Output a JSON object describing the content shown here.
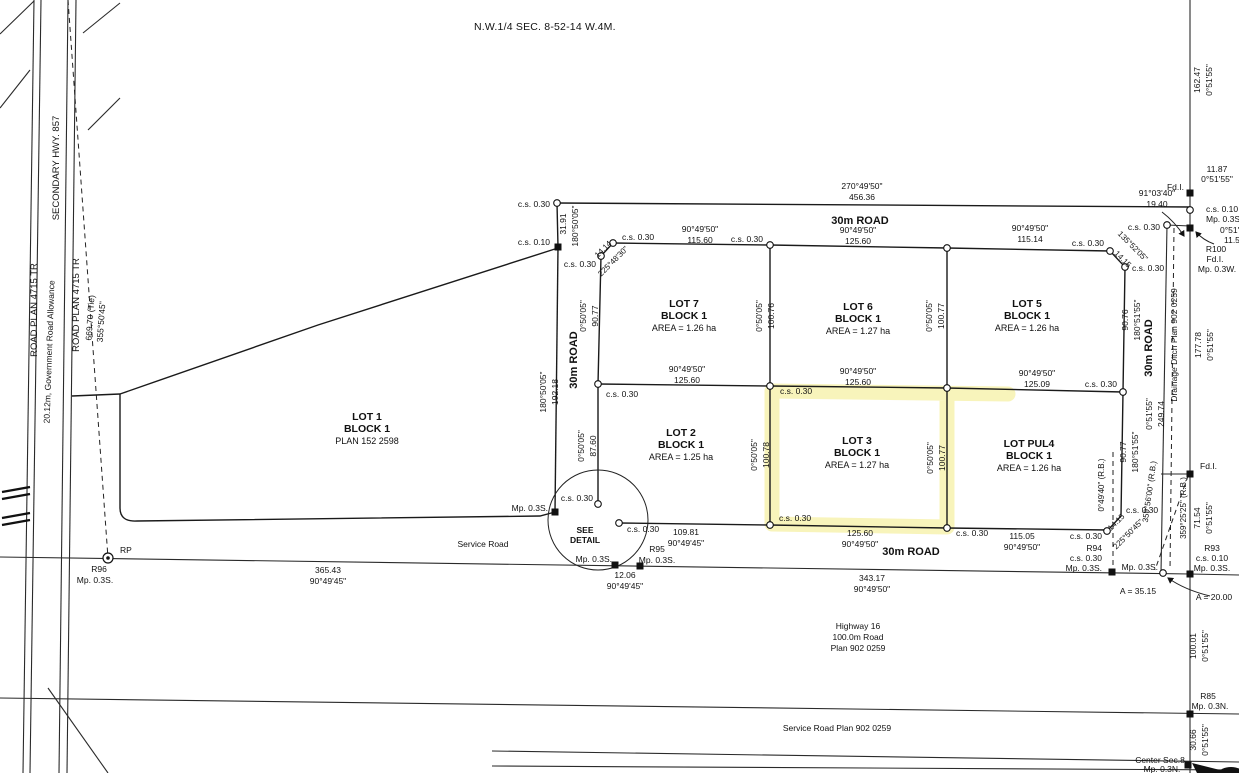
{
  "title": "N.W.1/4 SEC. 8-52-14 W.4M.",
  "colors": {
    "highlight": "#f3ec8e",
    "line": "#1a1a1a",
    "background": "#ffffff"
  },
  "highlighted_lot": "LOT 3",
  "labels": [
    {
      "t": "ROAD PLAN 4715 TR",
      "x": 37,
      "y": 310,
      "r": -90,
      "s": 9.5
    },
    {
      "t": "SECONDARY HWY. 857",
      "x": 59,
      "y": 168,
      "r": -90,
      "s": 9.5
    },
    {
      "t": "20.12m, Government Road Allowance",
      "x": 52,
      "y": 352,
      "r": -88,
      "s": 8.5
    },
    {
      "t": "ROAD PLAN 4715 TR",
      "x": 79,
      "y": 305,
      "r": -90,
      "s": 9.5
    },
    {
      "t": "669.70 (Tie)",
      "x": 93,
      "y": 318,
      "r": -86
    },
    {
      "t": "355°50'45\"",
      "x": 104,
      "y": 322,
      "r": -86
    },
    {
      "t": "c.s. 0.30",
      "x": 550,
      "y": 207,
      "a": "end"
    },
    {
      "t": "270°49'50\"",
      "x": 862,
      "y": 189
    },
    {
      "t": "456.36",
      "x": 862,
      "y": 200
    },
    {
      "t": "31.91",
      "x": 566,
      "y": 224,
      "r": -90
    },
    {
      "t": "180°50'05\"",
      "x": 578,
      "y": 226,
      "r": -90
    },
    {
      "t": "c.s. 0.10",
      "x": 550,
      "y": 245,
      "a": "end"
    },
    {
      "t": "30m ROAD",
      "x": 860,
      "y": 224,
      "b": 1,
      "s": 11
    },
    {
      "t": "90°49'50\"",
      "x": 700,
      "y": 232
    },
    {
      "t": "115.60",
      "x": 700,
      "y": 243
    },
    {
      "t": "c.s. 0.30",
      "x": 622,
      "y": 240,
      "a": "start"
    },
    {
      "t": "14.14",
      "x": 605,
      "y": 251,
      "r": -45,
      "s": 8
    },
    {
      "t": "225°48'30\"",
      "x": 615,
      "y": 263,
      "r": -45,
      "s": 8
    },
    {
      "t": "c.s. 0.30",
      "x": 596,
      "y": 267,
      "a": "end"
    },
    {
      "t": "90°49'50\"",
      "x": 858,
      "y": 233
    },
    {
      "t": "125.60",
      "x": 858,
      "y": 244
    },
    {
      "t": "c.s. 0.30",
      "x": 763,
      "y": 242,
      "a": "end"
    },
    {
      "t": "90°49'50\"",
      "x": 1030,
      "y": 231
    },
    {
      "t": "115.14",
      "x": 1030,
      "y": 242
    },
    {
      "t": "c.s. 0.30",
      "x": 1104,
      "y": 246,
      "a": "end"
    },
    {
      "t": "135°52'05\"",
      "x": 1131,
      "y": 248,
      "r": 45,
      "s": 8
    },
    {
      "t": "14.15",
      "x": 1121,
      "y": 261,
      "r": 45,
      "s": 8
    },
    {
      "t": "c.s. 0.30",
      "x": 1132,
      "y": 271,
      "a": "start"
    },
    {
      "t": "91°03'40\"",
      "x": 1157,
      "y": 196
    },
    {
      "t": "19.40",
      "x": 1157,
      "y": 207
    },
    {
      "t": "Fd.I.",
      "x": 1184,
      "y": 190,
      "a": "end"
    },
    {
      "t": "162.47",
      "x": 1200,
      "y": 80,
      "r": -90
    },
    {
      "t": "0°51'55\"",
      "x": 1212,
      "y": 80,
      "r": -90
    },
    {
      "t": "11.87",
      "x": 1217,
      "y": 172
    },
    {
      "t": "0°51'55\"",
      "x": 1217,
      "y": 182
    },
    {
      "t": "c.s. 0.10",
      "x": 1206,
      "y": 212,
      "a": "start"
    },
    {
      "t": "Mp. 0.3S.",
      "x": 1206,
      "y": 222,
      "a": "start"
    },
    {
      "t": "c.s. 0.30",
      "x": 1160,
      "y": 230,
      "a": "end"
    },
    {
      "t": "0°51'55\"",
      "x": 1220,
      "y": 233,
      "a": "start"
    },
    {
      "t": "11.55",
      "x": 1224,
      "y": 243,
      "a": "start"
    },
    {
      "t": "R100",
      "x": 1216,
      "y": 252
    },
    {
      "t": "Fd.I.",
      "x": 1215,
      "y": 262
    },
    {
      "t": "Mp. 0.3W.",
      "x": 1217,
      "y": 272
    },
    {
      "t": "LOT 7",
      "x": 684,
      "y": 307,
      "b": 1,
      "s": 10.5
    },
    {
      "t": "BLOCK 1",
      "x": 684,
      "y": 319,
      "b": 1,
      "s": 10.5
    },
    {
      "t": "AREA = 1.26 ha",
      "x": 684,
      "y": 331,
      "s": 9
    },
    {
      "t": "0°50'05\"",
      "x": 586,
      "y": 316,
      "r": -90
    },
    {
      "t": "90.77",
      "x": 598,
      "y": 316,
      "r": -90
    },
    {
      "t": "30m ROAD",
      "x": 577,
      "y": 360,
      "r": -90,
      "b": 1,
      "s": 11
    },
    {
      "t": "180°50'05\"",
      "x": 546,
      "y": 392,
      "r": -90
    },
    {
      "t": "192.18",
      "x": 558,
      "y": 392,
      "r": -90
    },
    {
      "t": "0°50'05\"",
      "x": 762,
      "y": 316,
      "r": -90
    },
    {
      "t": "100.76",
      "x": 774,
      "y": 316,
      "r": -90
    },
    {
      "t": "LOT 6",
      "x": 858,
      "y": 310,
      "b": 1,
      "s": 10.5
    },
    {
      "t": "BLOCK 1",
      "x": 858,
      "y": 322,
      "b": 1,
      "s": 10.5
    },
    {
      "t": "AREA = 1.27 ha",
      "x": 858,
      "y": 334,
      "s": 9
    },
    {
      "t": "0°50'05\"",
      "x": 932,
      "y": 316,
      "r": -90
    },
    {
      "t": "100.77",
      "x": 944,
      "y": 316,
      "r": -90
    },
    {
      "t": "LOT 5",
      "x": 1027,
      "y": 307,
      "b": 1,
      "s": 10.5
    },
    {
      "t": "BLOCK 1",
      "x": 1027,
      "y": 319,
      "b": 1,
      "s": 10.5
    },
    {
      "t": "AREA = 1.26 ha",
      "x": 1027,
      "y": 331,
      "s": 9
    },
    {
      "t": "90.76",
      "x": 1128,
      "y": 320,
      "r": -90
    },
    {
      "t": "180°51'55\"",
      "x": 1140,
      "y": 320,
      "r": -90
    },
    {
      "t": "30m ROAD",
      "x": 1152,
      "y": 348,
      "r": -90,
      "b": 1,
      "s": 11
    },
    {
      "t": "Drainage Ditch Plan 902 0259",
      "x": 1177,
      "y": 345,
      "r": -90
    },
    {
      "t": "177.78",
      "x": 1201,
      "y": 345,
      "r": -90
    },
    {
      "t": "0°51'55\"",
      "x": 1213,
      "y": 345,
      "r": -90
    },
    {
      "t": "90°49'50\"",
      "x": 687,
      "y": 372
    },
    {
      "t": "125.60",
      "x": 687,
      "y": 383
    },
    {
      "t": "c.s. 0.30",
      "x": 606,
      "y": 397,
      "a": "start"
    },
    {
      "t": "90°49'50\"",
      "x": 858,
      "y": 374
    },
    {
      "t": "125.60",
      "x": 858,
      "y": 385
    },
    {
      "t": "c.s. 0.30",
      "x": 780,
      "y": 394,
      "a": "start"
    },
    {
      "t": "90°49'50\"",
      "x": 1037,
      "y": 376
    },
    {
      "t": "125.09",
      "x": 1037,
      "y": 387
    },
    {
      "t": "c.s. 0.30",
      "x": 1117,
      "y": 387,
      "a": "end"
    },
    {
      "t": "0°51'55\"",
      "x": 1152,
      "y": 414,
      "r": -90
    },
    {
      "t": "249.74",
      "x": 1164,
      "y": 414,
      "r": -90
    },
    {
      "t": "LOT 1",
      "x": 367,
      "y": 420,
      "b": 1,
      "s": 10.5
    },
    {
      "t": "BLOCK 1",
      "x": 367,
      "y": 432,
      "b": 1,
      "s": 10.5
    },
    {
      "t": "PLAN 152 2598",
      "x": 367,
      "y": 444,
      "s": 9
    },
    {
      "t": "LOT 2",
      "x": 681,
      "y": 436,
      "b": 1,
      "s": 10.5
    },
    {
      "t": "BLOCK 1",
      "x": 681,
      "y": 448,
      "b": 1,
      "s": 10.5
    },
    {
      "t": "AREA = 1.25 ha",
      "x": 681,
      "y": 460,
      "s": 9
    },
    {
      "t": "0°50'05\"",
      "x": 584,
      "y": 446,
      "r": -90
    },
    {
      "t": "87.60",
      "x": 596,
      "y": 446,
      "r": -90
    },
    {
      "t": "0°50'05\"",
      "x": 757,
      "y": 455,
      "r": -90
    },
    {
      "t": "100.78",
      "x": 769,
      "y": 455,
      "r": -90
    },
    {
      "t": "LOT 3",
      "x": 857,
      "y": 444,
      "b": 1,
      "s": 10.5
    },
    {
      "t": "BLOCK 1",
      "x": 857,
      "y": 456,
      "b": 1,
      "s": 10.5
    },
    {
      "t": "AREA = 1.27 ha",
      "x": 857,
      "y": 468,
      "s": 9
    },
    {
      "t": "0°50'05\"",
      "x": 933,
      "y": 458,
      "r": -90
    },
    {
      "t": "100.77",
      "x": 945,
      "y": 458,
      "r": -90
    },
    {
      "t": "LOT PUL4",
      "x": 1029,
      "y": 447,
      "b": 1,
      "s": 10.5
    },
    {
      "t": "BLOCK 1",
      "x": 1029,
      "y": 459,
      "b": 1,
      "s": 10.5
    },
    {
      "t": "AREA = 1.26 ha",
      "x": 1029,
      "y": 471,
      "s": 9
    },
    {
      "t": "0°49'40\" (R.B.)",
      "x": 1104,
      "y": 485,
      "r": -90,
      "s": 8
    },
    {
      "t": "90.77",
      "x": 1126,
      "y": 452,
      "r": -90
    },
    {
      "t": "180°51'55\"",
      "x": 1138,
      "y": 452,
      "r": -90
    },
    {
      "t": "359°56'00\" (R.B.)",
      "x": 1152,
      "y": 492,
      "r": -82,
      "s": 8
    },
    {
      "t": "359°25'25\" (R.B.)",
      "x": 1186,
      "y": 508,
      "r": -90,
      "s": 8
    },
    {
      "t": "71.54",
      "x": 1200,
      "y": 518,
      "r": -90
    },
    {
      "t": "0°51'55\"",
      "x": 1212,
      "y": 518,
      "r": -90
    },
    {
      "t": "Fd.I.",
      "x": 1200,
      "y": 469,
      "a": "start"
    },
    {
      "t": "Mp. 0.3S.",
      "x": 548,
      "y": 511,
      "a": "end"
    },
    {
      "t": "c.s. 0.30",
      "x": 593,
      "y": 501,
      "a": "end"
    },
    {
      "t": "SEE",
      "x": 585,
      "y": 533,
      "b": 1,
      "s": 8.5
    },
    {
      "t": "DETAIL",
      "x": 585,
      "y": 543,
      "b": 1,
      "s": 8.5
    },
    {
      "t": "c.s. 0.30",
      "x": 627,
      "y": 532,
      "a": "start"
    },
    {
      "t": "109.81",
      "x": 686,
      "y": 535
    },
    {
      "t": "90°49'45\"",
      "x": 686,
      "y": 546
    },
    {
      "t": "c.s. 0.30",
      "x": 779,
      "y": 521,
      "a": "start"
    },
    {
      "t": "125.60",
      "x": 860,
      "y": 536
    },
    {
      "t": "90°49'50\"",
      "x": 860,
      "y": 547
    },
    {
      "t": "c.s. 0.30",
      "x": 956,
      "y": 536,
      "a": "start"
    },
    {
      "t": "115.05",
      "x": 1022,
      "y": 539
    },
    {
      "t": "90°49'50\"",
      "x": 1022,
      "y": 550
    },
    {
      "t": "c.s. 0.30",
      "x": 1102,
      "y": 539,
      "a": "end"
    },
    {
      "t": "14.15",
      "x": 1118,
      "y": 524,
      "r": -45,
      "s": 8
    },
    {
      "t": "225°50'45\"",
      "x": 1130,
      "y": 536,
      "r": -45,
      "s": 8
    },
    {
      "t": "c.s. 0.30",
      "x": 1126,
      "y": 513,
      "a": "start"
    },
    {
      "t": "R94",
      "x": 1102,
      "y": 551,
      "a": "end"
    },
    {
      "t": "c.s. 0.30",
      "x": 1102,
      "y": 561,
      "a": "end"
    },
    {
      "t": "Mp. 0.3S.",
      "x": 1102,
      "y": 571,
      "a": "end"
    },
    {
      "t": "Mp. 0.3S.",
      "x": 1158,
      "y": 570,
      "a": "end"
    },
    {
      "t": "R93",
      "x": 1212,
      "y": 551
    },
    {
      "t": "c.s. 0.10",
      "x": 1212,
      "y": 561
    },
    {
      "t": "Mp. 0.3S.",
      "x": 1212,
      "y": 571
    },
    {
      "t": "A = 35.15",
      "x": 1138,
      "y": 594
    },
    {
      "t": "A = 20.00",
      "x": 1214,
      "y": 600
    },
    {
      "t": "Service Road",
      "x": 483,
      "y": 547
    },
    {
      "t": "365.43",
      "x": 328,
      "y": 573
    },
    {
      "t": "90°49'45\"",
      "x": 328,
      "y": 584
    },
    {
      "t": "RP",
      "x": 120,
      "y": 553,
      "a": "start"
    },
    {
      "t": "R96",
      "x": 99,
      "y": 572
    },
    {
      "t": "Mp. 0.3S.",
      "x": 95,
      "y": 583
    },
    {
      "t": "Mp. 0.3S.",
      "x": 612,
      "y": 562,
      "a": "end"
    },
    {
      "t": "12.06",
      "x": 625,
      "y": 578
    },
    {
      "t": "90°49'45\"",
      "x": 625,
      "y": 589
    },
    {
      "t": "R95",
      "x": 657,
      "y": 552
    },
    {
      "t": "Mp. 0.3S.",
      "x": 657,
      "y": 563
    },
    {
      "t": "30m ROAD",
      "x": 911,
      "y": 555,
      "b": 1,
      "s": 11
    },
    {
      "t": "343.17",
      "x": 872,
      "y": 581
    },
    {
      "t": "90°49'50\"",
      "x": 872,
      "y": 592
    },
    {
      "t": "Highway 16",
      "x": 858,
      "y": 629
    },
    {
      "t": "100.0m Road",
      "x": 858,
      "y": 640
    },
    {
      "t": "Plan 902 0259",
      "x": 858,
      "y": 651
    },
    {
      "t": "Service Road Plan 902 0259",
      "x": 837,
      "y": 731
    },
    {
      "t": "100.01",
      "x": 1196,
      "y": 646,
      "r": -90
    },
    {
      "t": "0°51'55\"",
      "x": 1208,
      "y": 646,
      "r": -90
    },
    {
      "t": "R85",
      "x": 1208,
      "y": 699
    },
    {
      "t": "Mp. 0.3N.",
      "x": 1210,
      "y": 709
    },
    {
      "t": "30.66",
      "x": 1196,
      "y": 740,
      "r": -90
    },
    {
      "t": "0°51'55\"",
      "x": 1208,
      "y": 740,
      "r": -90
    },
    {
      "t": "Center Sec.8",
      "x": 1160,
      "y": 763
    },
    {
      "t": "Mp. 0.3N.",
      "x": 1162,
      "y": 772
    }
  ],
  "markers": {
    "circles": [
      [
        557,
        203
      ],
      [
        613,
        243
      ],
      [
        601,
        256
      ],
      [
        770,
        245
      ],
      [
        947,
        248
      ],
      [
        1110,
        251
      ],
      [
        1125,
        267
      ],
      [
        1167,
        225
      ],
      [
        1190,
        210
      ],
      [
        598,
        384
      ],
      [
        770,
        386
      ],
      [
        947,
        388
      ],
      [
        1123,
        392
      ],
      [
        598,
        504
      ],
      [
        619,
        523
      ],
      [
        770,
        525
      ],
      [
        947,
        528
      ],
      [
        1107,
        531
      ],
      [
        1163,
        573
      ]
    ],
    "squares": [
      [
        558,
        247
      ],
      [
        555,
        512
      ],
      [
        1190,
        193
      ],
      [
        1190,
        228
      ],
      [
        1190,
        474
      ],
      [
        615,
        565
      ],
      [
        640,
        566
      ],
      [
        1112,
        572
      ],
      [
        1190,
        574
      ],
      [
        1190,
        714
      ],
      [
        1188,
        765
      ]
    ],
    "rp": [
      [
        108,
        558
      ]
    ]
  }
}
